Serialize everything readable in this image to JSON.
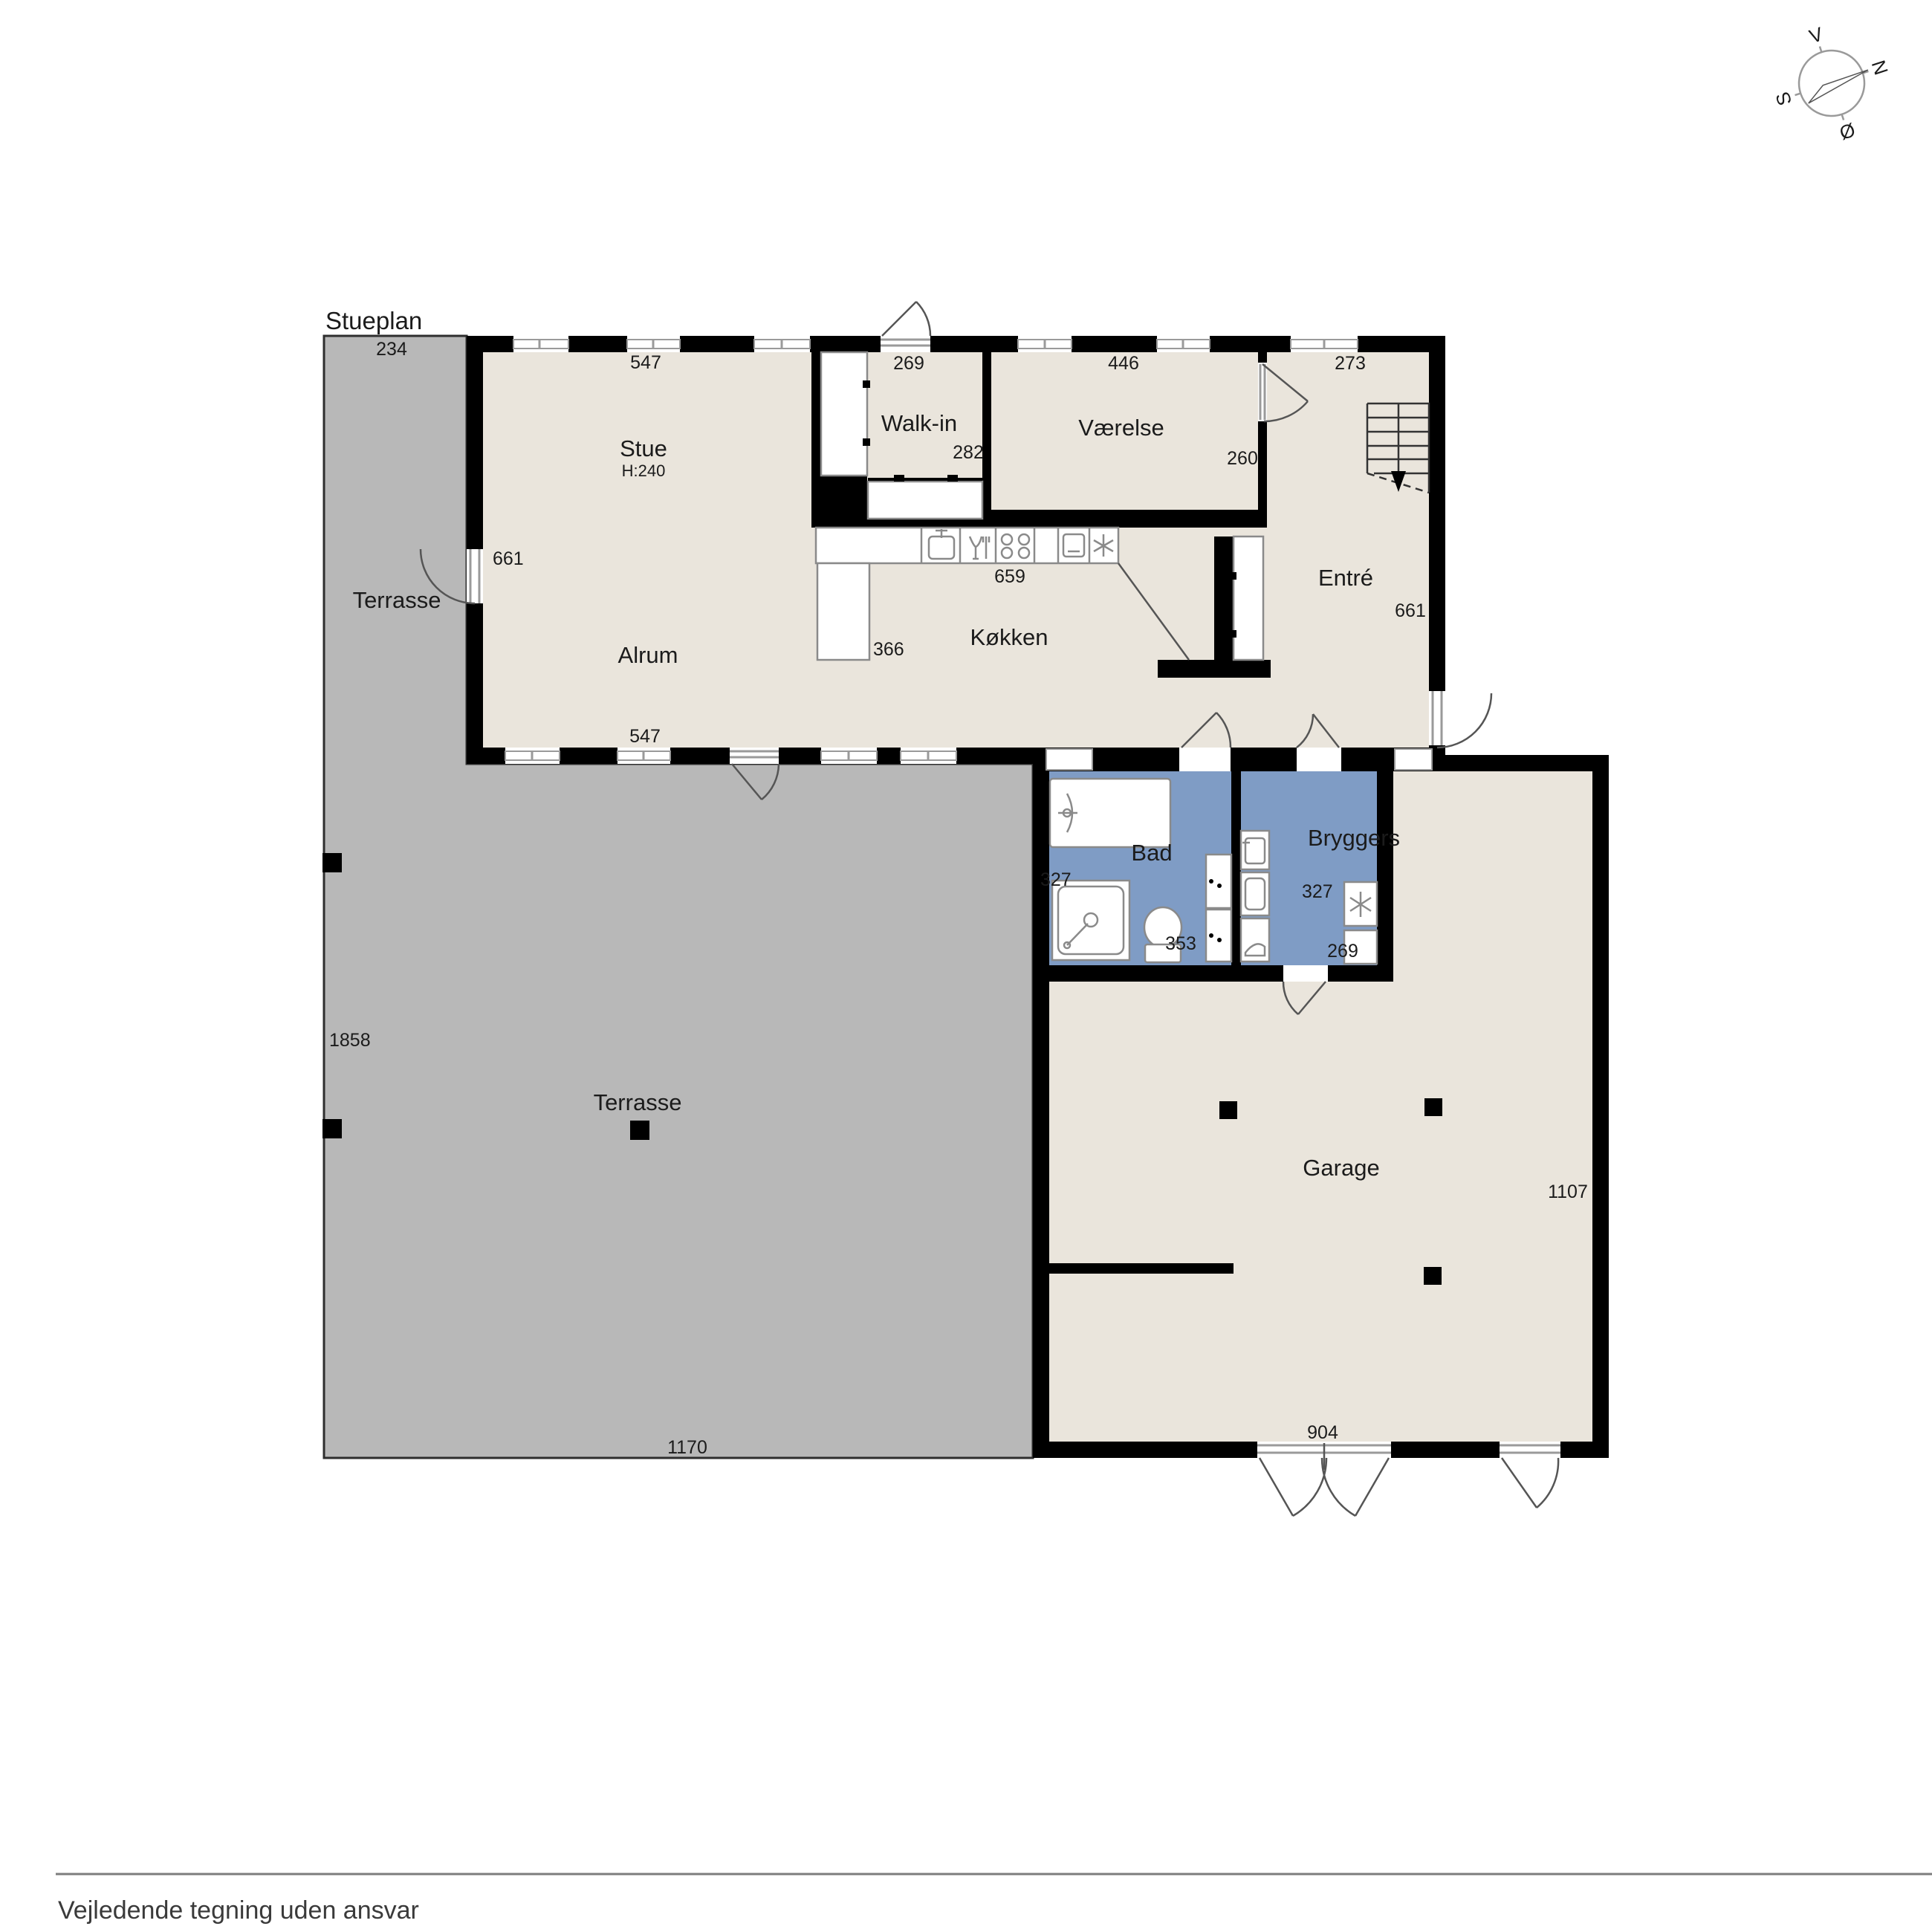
{
  "title": "Stueplan",
  "footer": {
    "disclaimer": "Vejledende tegning uden ansvar"
  },
  "compass": {
    "n": "N",
    "s": "S",
    "e": "Ø",
    "w": "V"
  },
  "rooms": {
    "stue": {
      "label": "Stue",
      "ceiling": "H:240"
    },
    "walk_in": {
      "label": "Walk-in"
    },
    "vaerelse": {
      "label": "Værelse"
    },
    "entre": {
      "label": "Entré"
    },
    "alrum": {
      "label": "Alrum"
    },
    "koekken": {
      "label": "Køkken"
    },
    "bad": {
      "label": "Bad"
    },
    "bryggers": {
      "label": "Bryggers"
    },
    "garage": {
      "label": "Garage"
    },
    "terrasse_upper": {
      "label": "Terrasse"
    },
    "terrasse_main": {
      "label": "Terrasse"
    }
  },
  "dimensions": {
    "terrasse_top": "234",
    "stue_top": "547",
    "walk_in_top": "269",
    "vaerelse_top": "446",
    "entre_top": "273",
    "stue_west": "661",
    "walk_in_east": "282",
    "vaerelse_east": "260",
    "koekken_counter": "659",
    "koekken_island": "366",
    "entre_east": "661",
    "alrum_bottom": "547",
    "bad_west": "327",
    "bad_bottom": "353",
    "bryggers_west": "327",
    "bryggers_bottom": "269",
    "terrasse_west": "1858",
    "terrasse_bottom": "1170",
    "garage_east": "1107",
    "garage_bottom": "904"
  },
  "colors": {
    "wall": "#000000",
    "floor": "#eae5dc",
    "terrace": "#b8b8b8",
    "wet": "#7f9cc5",
    "fix-stroke": "#8a8a8a",
    "text": "#1b1b1b",
    "footer-line": "#7d7d7d",
    "footer-text": "#3a3a3a"
  }
}
